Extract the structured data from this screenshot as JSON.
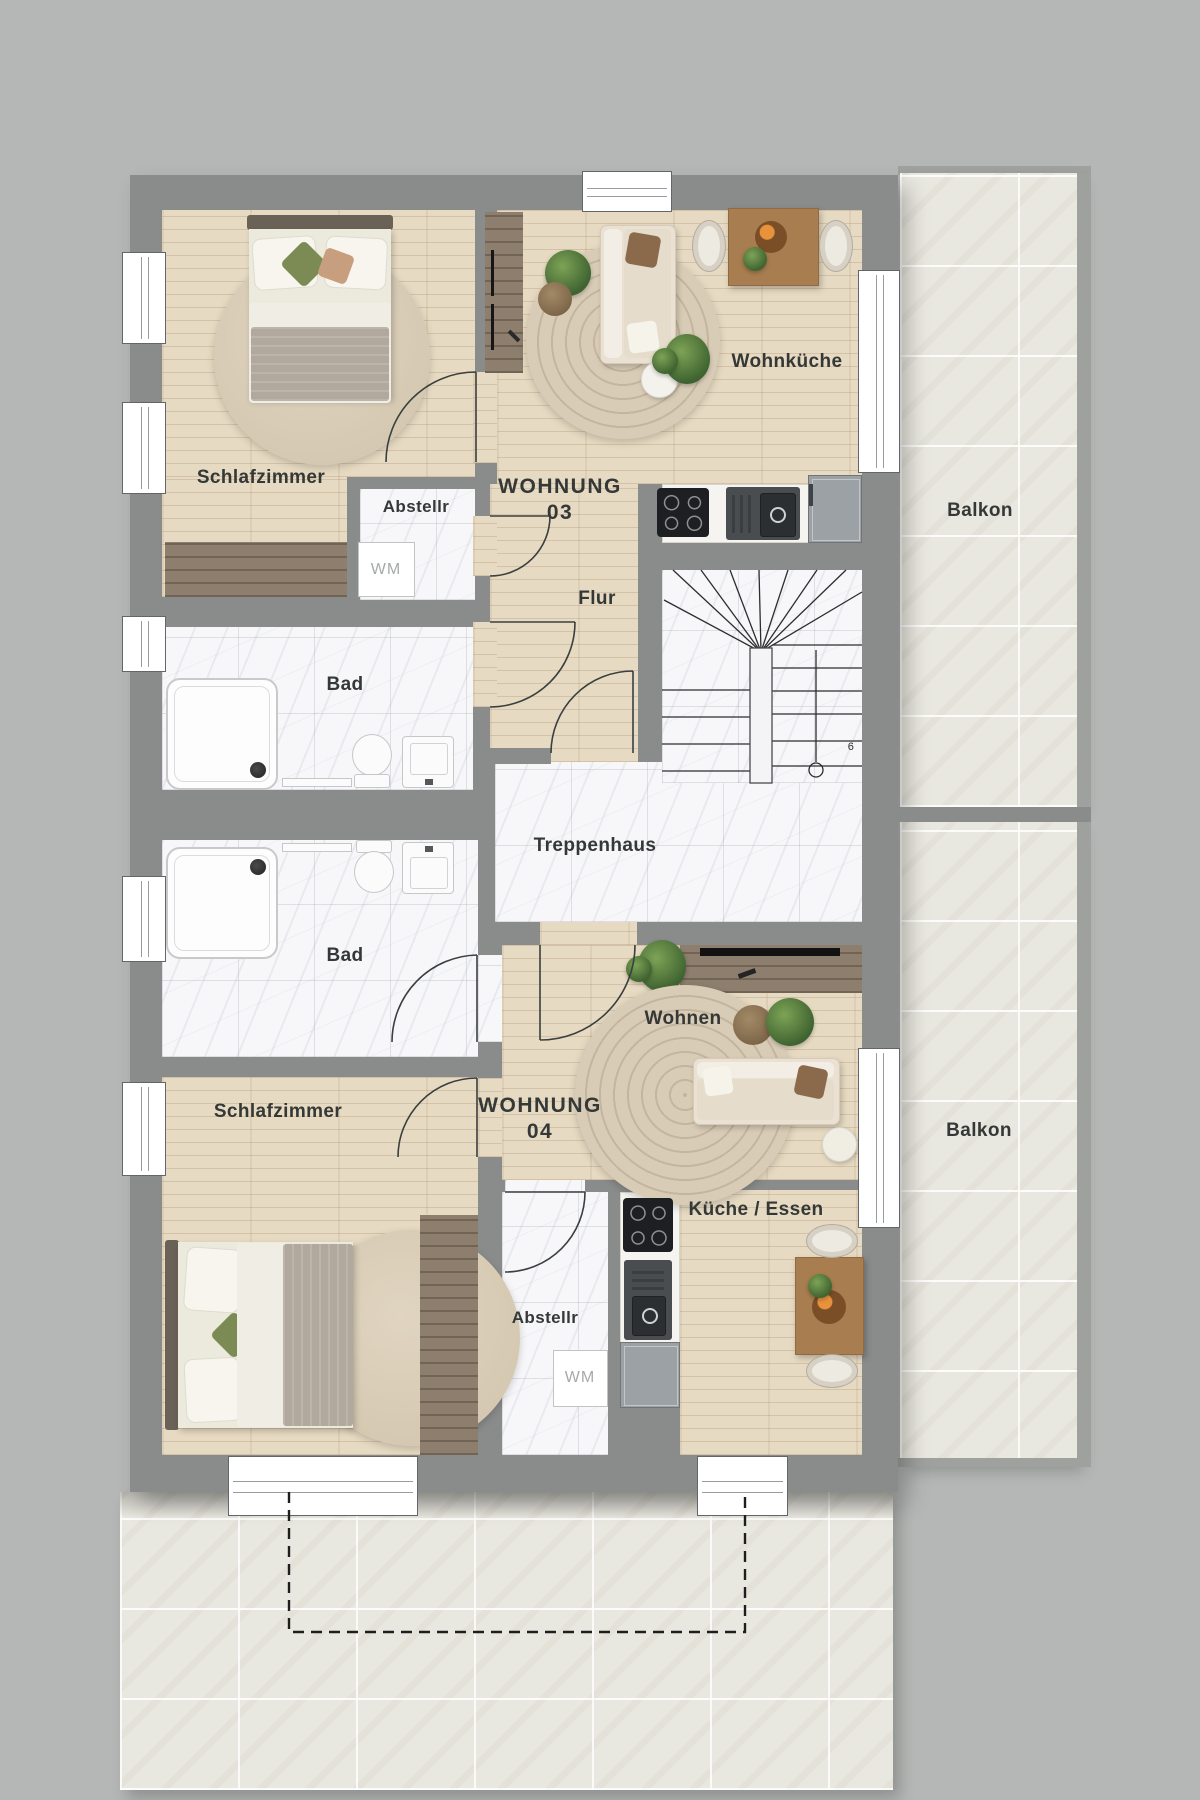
{
  "plan": {
    "apartments": [
      {
        "id": "wohnung-03",
        "label_line1": "WOHNUNG",
        "label_line2": "03"
      },
      {
        "id": "wohnung-04",
        "label_line1": "WOHNUNG",
        "label_line2": "04"
      }
    ],
    "rooms": {
      "schlafzimmer_top": "Schlafzimmer",
      "abstellraum_top": "Abstellr",
      "wohnkueche": "Wohnküche",
      "flur": "Flur",
      "bad_top": "Bad",
      "treppenhaus": "Treppenhaus",
      "bad_bottom": "Bad",
      "wohnen": "Wohnen",
      "kueche_essen": "Küche / Essen",
      "abstellraum_bottom": "Abstellr",
      "schlafzimmer_bottom": "Schlafzimmer",
      "balkon_top": "Balkon",
      "balkon_bottom": "Balkon"
    },
    "appliances": {
      "washing_machine_top": "WM",
      "washing_machine_bottom": "WM"
    },
    "stairs": {
      "step_number": "6"
    },
    "colors": {
      "background": "#b5b7b6",
      "wall": "#8a8c8b",
      "wood_floor": "#e7dac2",
      "dark_wood": "#8d7e6d",
      "marble": "#f7f7f9",
      "balcony_tile": "#e9e8e0",
      "label_text": "#343836",
      "plant_green": "#4f7038",
      "appliance_dark": "#1e1f22"
    }
  }
}
